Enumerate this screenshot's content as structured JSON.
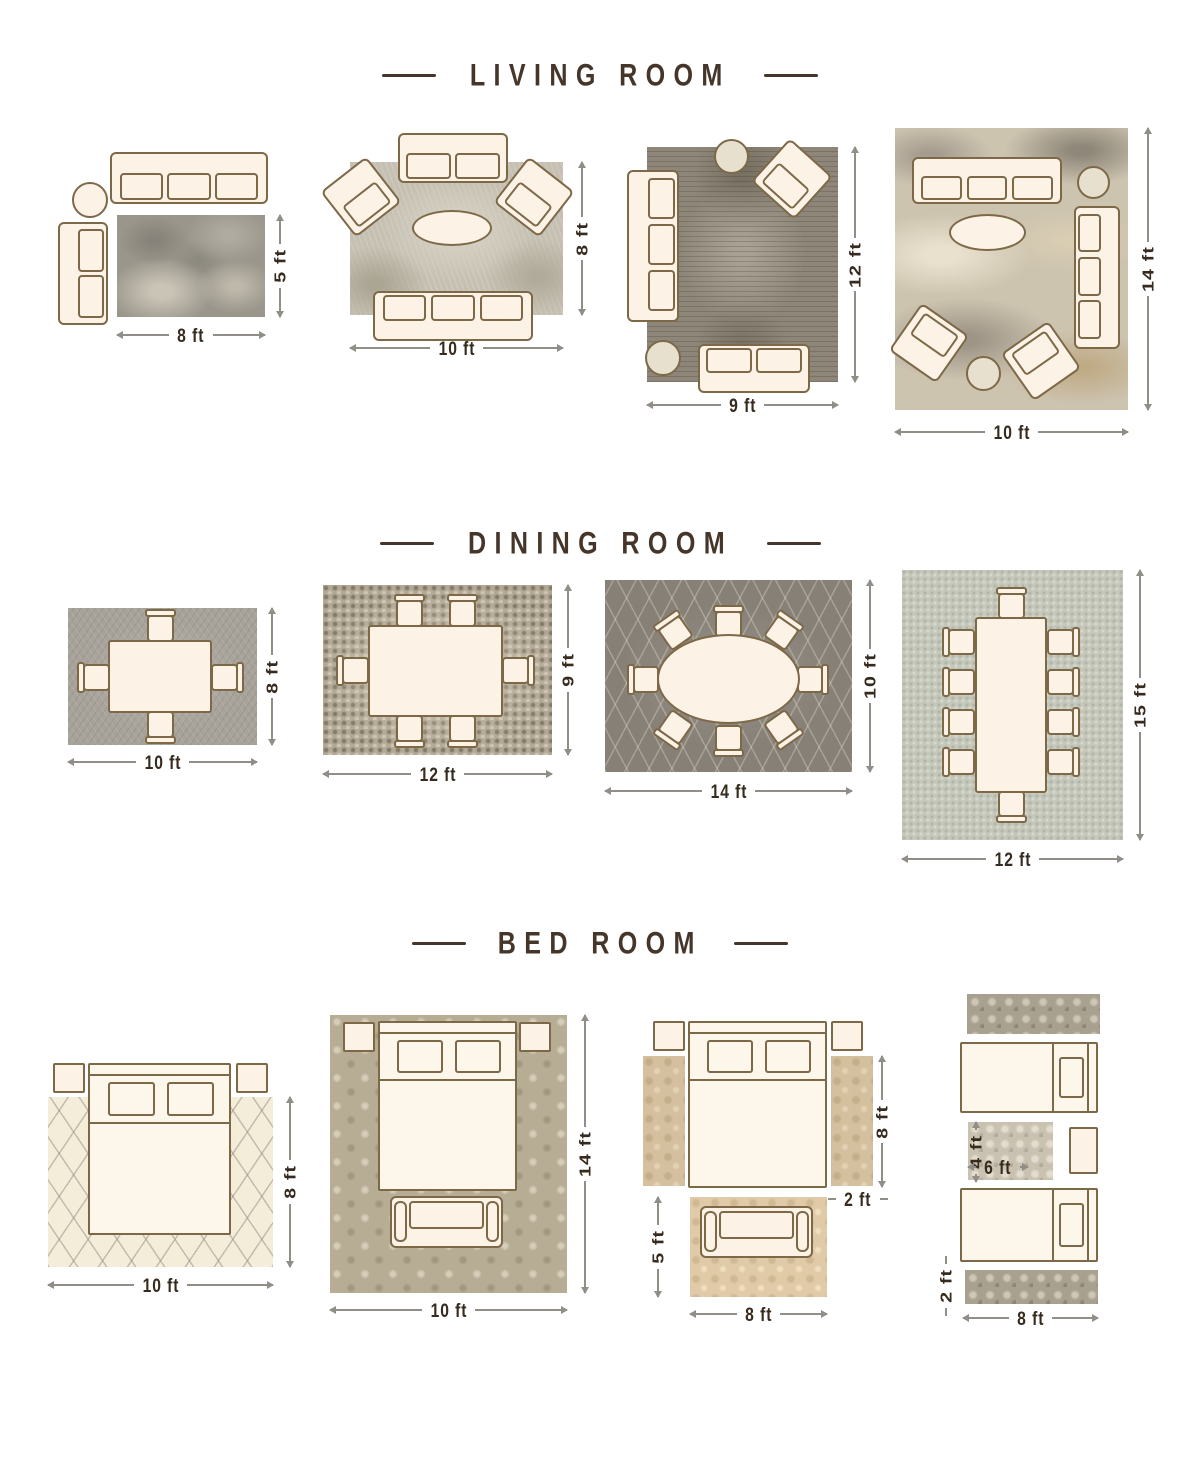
{
  "colors": {
    "title": "#46362a",
    "dimension_label": "#362b1e",
    "dimension_line": "#908e87",
    "furniture_fill": "#fcf3e6",
    "furniture_outline": "#7d6947",
    "background": "#ffffff"
  },
  "sections": [
    {
      "title": "LIVING ROOM",
      "layouts": [
        {
          "width": "8 ft",
          "height": "5 ft"
        },
        {
          "width": "10 ft",
          "height": "8 ft"
        },
        {
          "width": "9 ft",
          "height": "12 ft"
        },
        {
          "width": "10 ft",
          "height": "14 ft"
        }
      ]
    },
    {
      "title": "DINING ROOM",
      "layouts": [
        {
          "width": "10 ft",
          "height": "8 ft"
        },
        {
          "width": "12 ft",
          "height": "9 ft"
        },
        {
          "width": "14 ft",
          "height": "10 ft"
        },
        {
          "width": "12 ft",
          "height": "15 ft"
        }
      ]
    },
    {
      "title": "BED ROOM",
      "layouts": [
        {
          "width": "10 ft",
          "height": "8 ft"
        },
        {
          "width": "10 ft",
          "height": "14 ft"
        },
        {
          "bed_side_height": "8 ft",
          "runner_width": "2 ft",
          "front_rug_height": "5 ft",
          "front_rug_width": "8 ft"
        },
        {
          "accent_rug_height": "4 ft",
          "accent_rug_width": "6 ft",
          "runner_height": "2 ft",
          "runner_width": "8 ft"
        }
      ]
    }
  ]
}
